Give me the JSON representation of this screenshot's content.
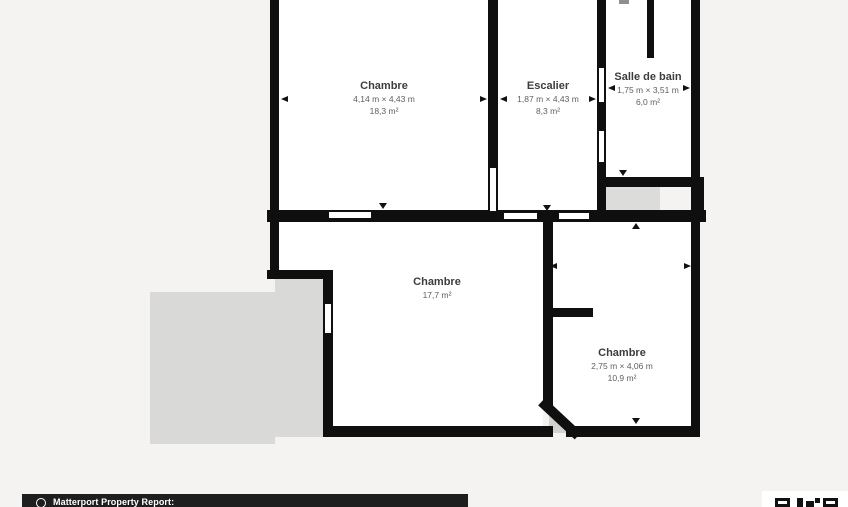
{
  "plan": {
    "rooms": [
      {
        "name": "Chambre",
        "dimensions": "4,14 m × 4,43 m",
        "area": "18,3 m²"
      },
      {
        "name": "Escalier",
        "dimensions": "1,87 m × 4,43 m",
        "area": "8,3 m²"
      },
      {
        "name": "Salle de bain",
        "dimensions": "1,75 m × 3,51 m",
        "area": "6,0 m²"
      },
      {
        "name": "Chambre",
        "area": "17,7 m²"
      },
      {
        "name": "Chambre",
        "dimensions": "2,75 m × 4,06 m",
        "area": "10,9 m²"
      }
    ]
  },
  "footer": {
    "report_label": "Matterport Property Report:",
    "logo": "matterport-logo",
    "qr": "qr-code"
  },
  "colors": {
    "background": "#f4f3f1",
    "wall": "#0f0f0f",
    "room_fill": "#ffffff",
    "terrace_fill": "#d9d9d7",
    "room_name_text": "#3d3d3d",
    "room_dims_text": "#5e5e5e",
    "footer_bg": "#1e1e1e",
    "footer_text": "#ffffff"
  }
}
